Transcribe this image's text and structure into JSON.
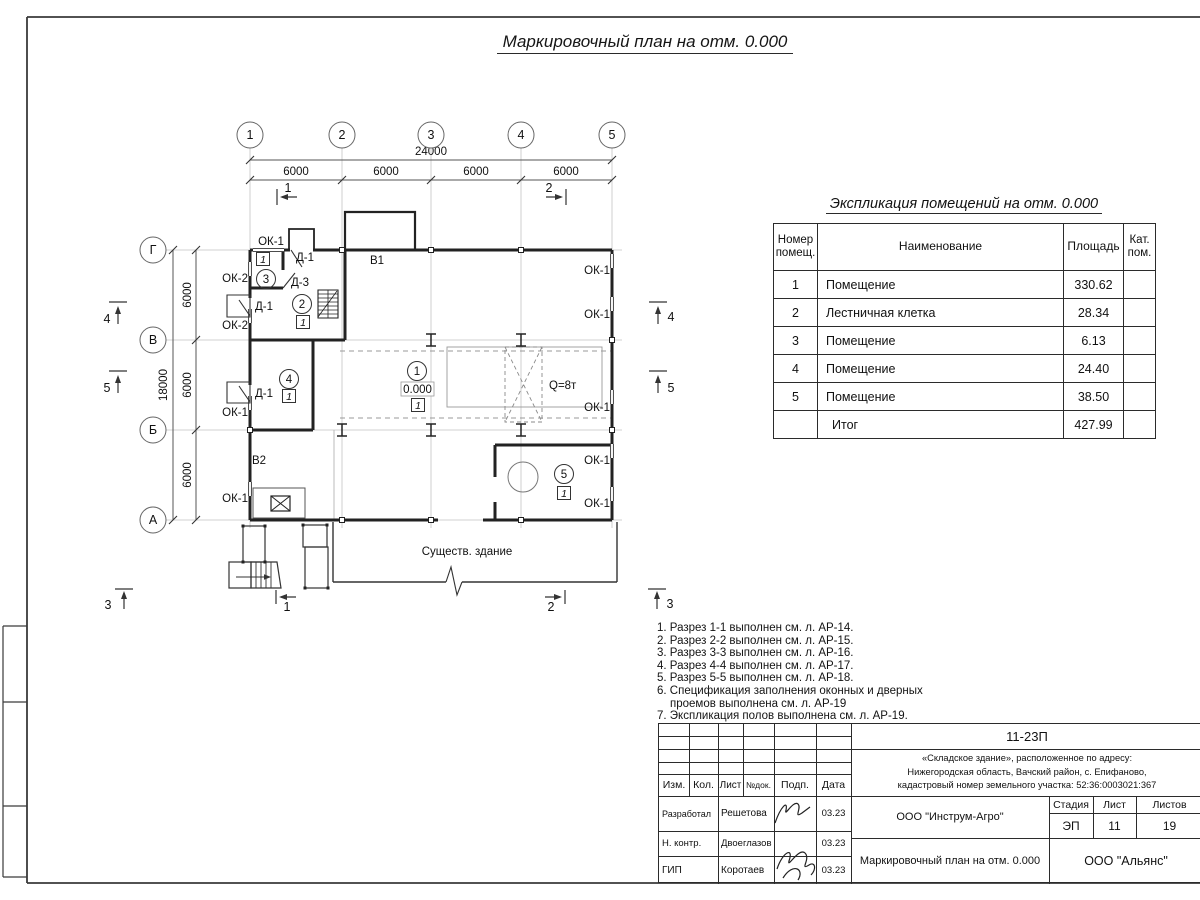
{
  "title": "Маркировочный план на отм. 0.000",
  "plan": {
    "axes_top": [
      "1",
      "2",
      "3",
      "4",
      "5"
    ],
    "axes_left": [
      "Г",
      "В",
      "Б",
      "А"
    ],
    "dims": {
      "total_top": "24000",
      "top_bays": [
        "6000",
        "6000",
        "6000",
        "6000"
      ],
      "total_left": "18000",
      "left_bays": [
        "6000",
        "6000",
        "6000"
      ]
    },
    "sections": {
      "s1": "1",
      "s2": "2",
      "s3": "3",
      "s4": "4",
      "s5": "5"
    },
    "rooms": [
      "1",
      "2",
      "3",
      "4",
      "5"
    ],
    "floor_mark": "1",
    "level": "0.000",
    "crane": "Q=8т",
    "labels": {
      "ok1": "ОК-1",
      "ok2": "ОК-2",
      "d1": "Д-1",
      "d3": "Д-3",
      "v1": "В1",
      "v2": "В2",
      "existing": "Существ. здание"
    }
  },
  "spec_table": {
    "title": "Экспликация помещений на отм. 0.000",
    "headers": {
      "num": "Номер помещ.",
      "name": "Наименование",
      "area": "Площадь",
      "cat": "Кат. пом."
    },
    "rows": [
      {
        "num": "1",
        "name": "Помещение",
        "area": "330.62",
        "cat": ""
      },
      {
        "num": "2",
        "name": "Лестничная клетка",
        "area": "28.34",
        "cat": ""
      },
      {
        "num": "3",
        "name": "Помещение",
        "area": "6.13",
        "cat": ""
      },
      {
        "num": "4",
        "name": "Помещение",
        "area": "24.40",
        "cat": ""
      },
      {
        "num": "5",
        "name": "Помещение",
        "area": "38.50",
        "cat": ""
      },
      {
        "num": "",
        "name": "Итог",
        "area": "427.99",
        "cat": ""
      }
    ]
  },
  "notes": {
    "lines": [
      "1. Разрез 1-1 выполнен см. л. АР-14.",
      "2. Разрез 2-2 выполнен см. л. АР-15.",
      "3. Разрез 3-3 выполнен см. л. АР-16.",
      "4. Разрез 4-4 выполнен см. л. АР-17.",
      "5. Разрез 5-5 выполнен см. л. АР-18.",
      "6. Спецификация заполнения оконных и дверных",
      "проемов выполнена см. л. АР-19",
      "7. Экспликация полов выполнена см. л. АР-19."
    ]
  },
  "titleblock": {
    "code": "11-23П",
    "object_lines": [
      "«Складское здание», расположенное по адресу:",
      "Нижегородская область, Вачский район, с. Епифаново,",
      "кадастровый номер земельного участка: 52:36:0003021:367"
    ],
    "cols": {
      "izm": "Изм.",
      "kol": "Кол.",
      "list": "Лист",
      "ndok": "№док.",
      "podp": "Подп.",
      "data": "Дата"
    },
    "roles": [
      {
        "role": "Разработал",
        "name": "Решетова",
        "date": "03.23"
      },
      {
        "role": "Н. контр.",
        "name": "Двоеглазов",
        "date": "03.23"
      },
      {
        "role": "ГИП",
        "name": "Коротаев",
        "date": "03.23"
      }
    ],
    "org": "ООО \"Инструм-Агро\"",
    "stage_label": "Стадия",
    "sheet_label": "Лист",
    "sheets_label": "Листов",
    "stage": "ЭП",
    "sheet": "11",
    "sheets": "19",
    "doc_title": "Маркировочный план на отм. 0.000",
    "company": "ООО \"Альянс\""
  }
}
